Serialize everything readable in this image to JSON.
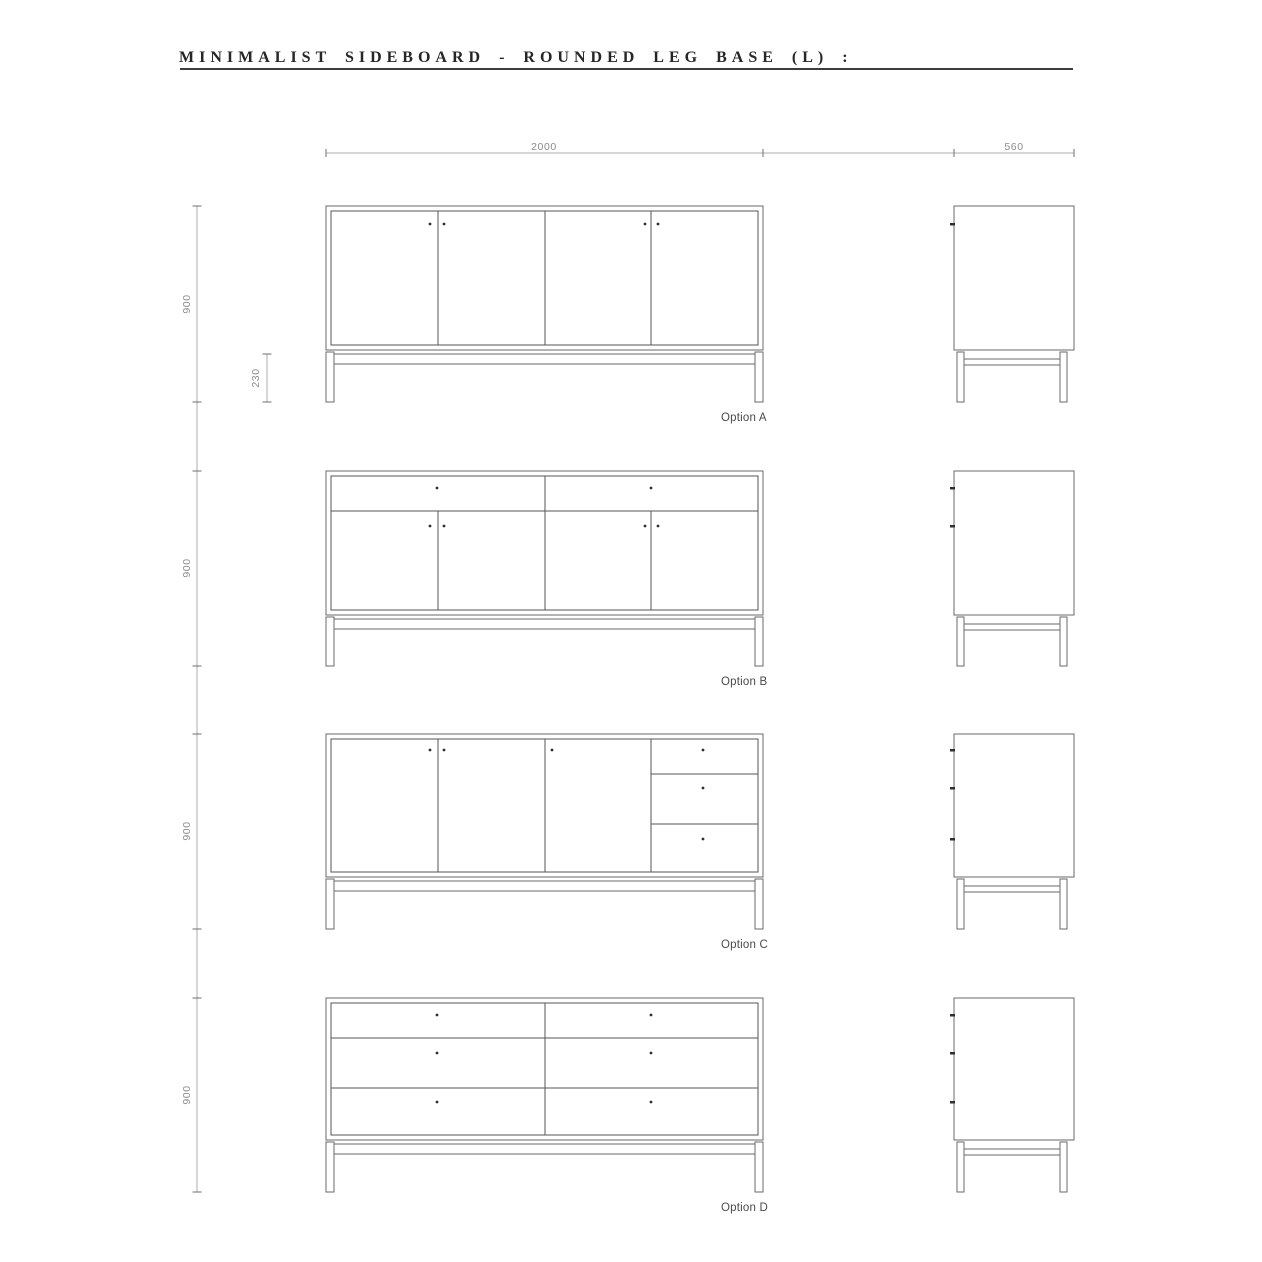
{
  "sheet": {
    "title": "MINIMALIST SIDEBOARD - ROUNDED LEG BASE (L) :"
  },
  "dimensions": {
    "front_width": "2000",
    "side_depth": "560",
    "overall_height": "900",
    "leg_height": "230"
  },
  "options": [
    {
      "label": "Option A",
      "config": "four doors",
      "cab_top": 206,
      "cab_bottom": 350,
      "leg_bottom": 402,
      "v_dividers": [
        {
          "x": 438
        },
        {
          "x": 545
        },
        {
          "x": 651
        }
      ],
      "h_dividers": [],
      "handle_dots": [
        [
          430,
          224
        ],
        [
          444,
          224
        ],
        [
          645,
          224
        ],
        [
          658,
          224
        ]
      ],
      "side_handle_ticks": [
        224
      ]
    },
    {
      "label": "Option B",
      "config": "two drawers over four doors",
      "cab_top": 471,
      "cab_bottom": 615,
      "leg_bottom": 666,
      "v_dividers": [
        {
          "x": 545
        },
        {
          "x": 438,
          "y1": 511
        },
        {
          "x": 651,
          "y1": 511
        }
      ],
      "h_dividers": [
        {
          "y": 511
        }
      ],
      "handle_dots": [
        [
          437,
          488
        ],
        [
          651,
          488
        ],
        [
          430,
          526
        ],
        [
          444,
          526
        ],
        [
          645,
          526
        ],
        [
          658,
          526
        ]
      ],
      "side_handle_ticks": [
        488,
        526
      ]
    },
    {
      "label": "Option C",
      "config": "three doors with three side drawers",
      "cab_top": 734,
      "cab_bottom": 877,
      "leg_bottom": 929,
      "v_dividers": [
        {
          "x": 438
        },
        {
          "x": 545
        },
        {
          "x": 651
        }
      ],
      "h_dividers": [
        {
          "y": 774,
          "x1": 651
        },
        {
          "y": 824,
          "x1": 651
        }
      ],
      "handle_dots": [
        [
          430,
          750
        ],
        [
          444,
          750
        ],
        [
          552,
          750
        ],
        [
          703,
          750
        ],
        [
          703,
          788
        ],
        [
          703,
          839
        ]
      ],
      "side_handle_ticks": [
        750,
        788,
        839
      ]
    },
    {
      "label": "Option D",
      "config": "six drawers",
      "cab_top": 998,
      "cab_bottom": 1140,
      "leg_bottom": 1192,
      "v_dividers": [
        {
          "x": 545
        }
      ],
      "h_dividers": [
        {
          "y": 1038
        },
        {
          "y": 1088
        }
      ],
      "handle_dots": [
        [
          437,
          1015
        ],
        [
          651,
          1015
        ],
        [
          437,
          1053
        ],
        [
          651,
          1053
        ],
        [
          437,
          1102
        ],
        [
          651,
          1102
        ]
      ],
      "side_handle_ticks": [
        1015,
        1053,
        1102
      ]
    }
  ],
  "drawing": {
    "front_x": 326,
    "front_w": 437,
    "side_x": 954,
    "side_w": 120,
    "inset": 5,
    "top_dim": {
      "y": 153,
      "x1": 326,
      "x2": 1074,
      "ticks": [
        326,
        763,
        954,
        1074
      ]
    },
    "left_dim": {
      "x": 197,
      "y1": 206,
      "y2": 1192,
      "ticks": [
        206,
        402,
        471,
        666,
        734,
        929,
        998,
        1192
      ]
    },
    "leg_dim": {
      "x": 267,
      "y1": 354,
      "y2": 402
    }
  },
  "colors": {
    "outline": "#6a6a6a",
    "divider": "#555555",
    "handle": "#2f2f2f",
    "dim_line": "#aeaeae",
    "dim_tick": "#6f6f6f",
    "dim_text": "#8c8c8c",
    "label_text": "#4a4a4a",
    "title_text": "#262626",
    "rule": "#3c3c3c"
  }
}
